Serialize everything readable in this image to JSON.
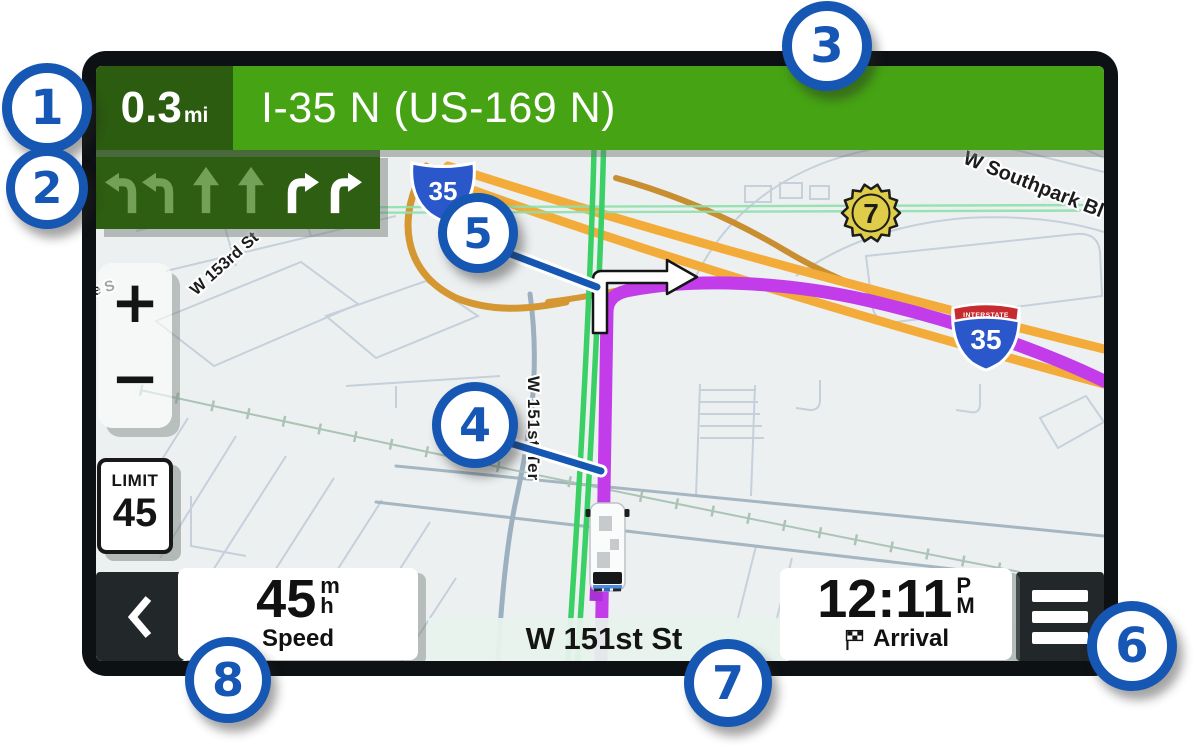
{
  "navigation_bar": {
    "distance_value": "0.3",
    "distance_unit": "mi",
    "instruction": "I-35 N (US-169 N)"
  },
  "lane_guidance": {
    "lanes": [
      "turn-left",
      "turn-left",
      "straight",
      "straight",
      "turn-right",
      "turn-right"
    ],
    "recommended_lanes": [
      "turn-right",
      "turn-right"
    ]
  },
  "map": {
    "labels": {
      "southpark_road": "W Southpark Bl",
      "w153rd_road": "W 153rd St",
      "w151st_ter_road": "W 151st Ter",
      "partial_road": "ce S"
    },
    "shields": {
      "top_shield_number": "35",
      "interstate_banner": "INTERSTATE",
      "interstate_number": "35",
      "exit_badge_number": "7"
    },
    "speed_limit": {
      "label": "LIMIT",
      "value": "45"
    }
  },
  "zoom_controls": {
    "zoom_in_label": "+",
    "zoom_out_label": "−"
  },
  "status_bar": {
    "speed": {
      "value": "45",
      "unit_numerator": "m",
      "unit_denominator": "h",
      "label": "Speed"
    },
    "current_street": "W 151st St",
    "arrival": {
      "time": "12:11",
      "meridiem_top": "P",
      "meridiem_bottom": "M",
      "label": "Arrival"
    }
  },
  "callouts": {
    "items": [
      {
        "label": "1"
      },
      {
        "label": "2"
      },
      {
        "label": "3"
      },
      {
        "label": "4"
      },
      {
        "label": "5"
      },
      {
        "label": "6"
      },
      {
        "label": "7"
      },
      {
        "label": "8"
      }
    ]
  },
  "colors": {
    "callout_blue": "#1557b2",
    "navigation_green": "#46a414",
    "navigation_dark_green": "#2b5c10",
    "route_purple": "#c33cea",
    "highway_orange": "#f3ac3a",
    "traffic_green": "#3ad066"
  }
}
